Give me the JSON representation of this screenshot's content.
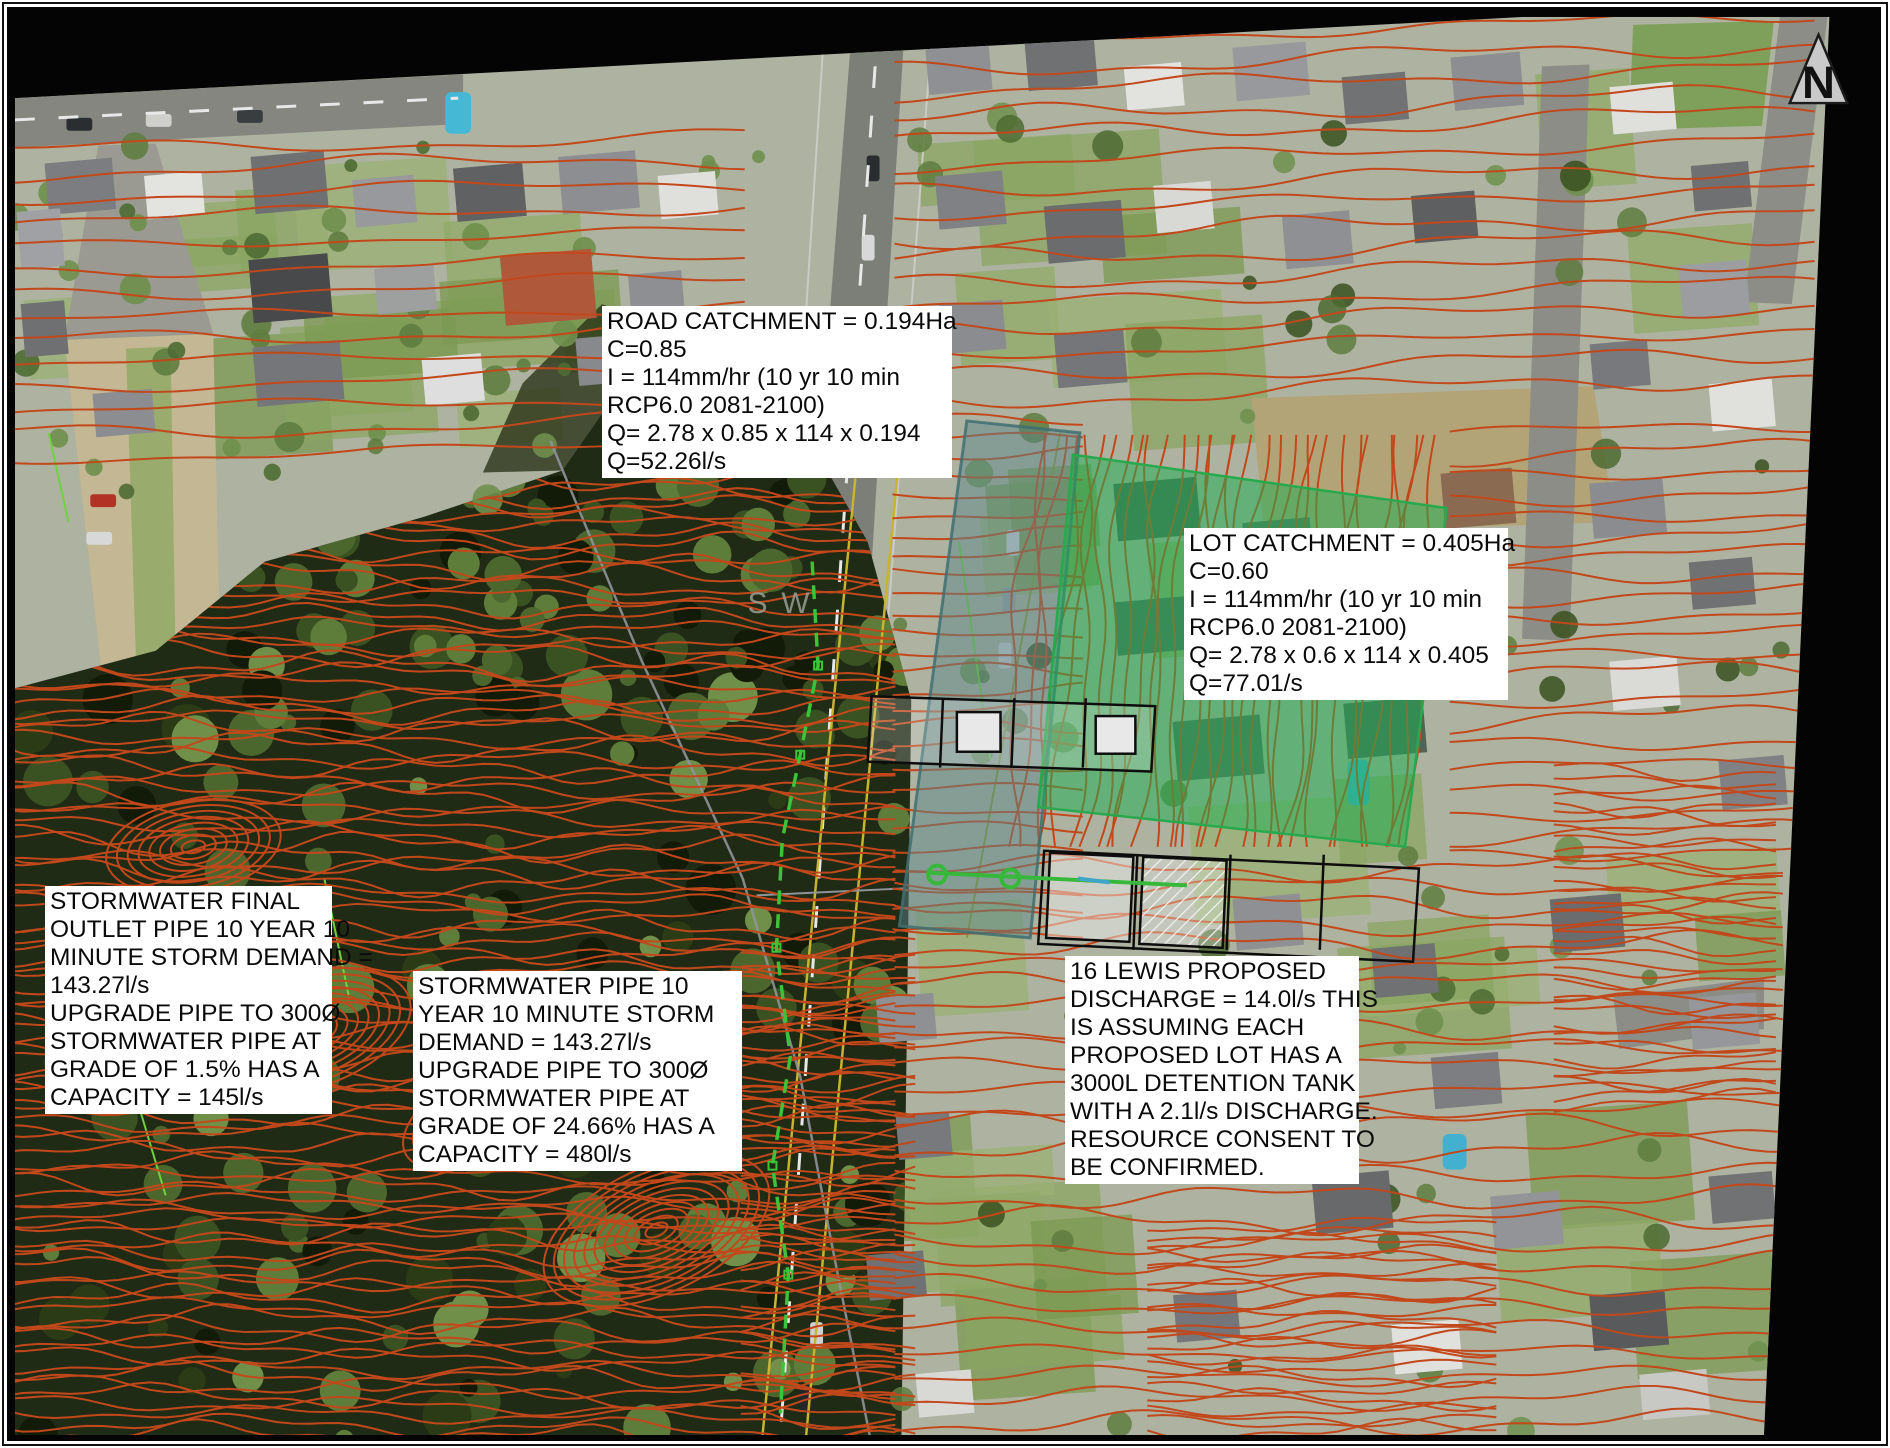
{
  "annotations": {
    "road_catchment": {
      "lines": [
        "ROAD CATCHMENT = 0.194Ha",
        "C=0.85",
        "I = 114mm/hr (10 yr 10 min",
        "RCP6.0 2081-2100)",
        "Q= 2.78 x 0.85 x 114 x 0.194",
        "Q=52.26l/s"
      ]
    },
    "lot_catchment": {
      "lines": [
        "LOT CATCHMENT = 0.405Ha",
        "C=0.60",
        "I = 114mm/hr (10 yr 10 min",
        "RCP6.0 2081-2100)",
        "Q= 2.78 x 0.6 x 114 x 0.405",
        "Q=77.01/s"
      ]
    },
    "stormwater_outlet": {
      "lines": [
        "STORMWATER FINAL",
        "OUTLET PIPE 10 YEAR 10",
        "MINUTE STORM DEMAND =",
        "143.27l/s",
        "UPGRADE PIPE TO 300Ø",
        "STORMWATER PIPE AT",
        "GRADE OF 1.5% HAS A",
        "CAPACITY = 145l/s"
      ]
    },
    "stormwater_pipe": {
      "lines": [
        "STORMWATER PIPE 10",
        "YEAR 10 MINUTE STORM",
        "DEMAND = 143.27l/s",
        "UPGRADE PIPE TO 300Ø",
        "STORMWATER PIPE AT",
        "GRADE OF 24.66% HAS A",
        "CAPACITY = 480l/s"
      ]
    },
    "lewis_discharge": {
      "lines": [
        "16 LEWIS PROPOSED",
        "DISCHARGE = 14.0l/s THIS",
        "IS ASSUMING EACH",
        "PROPOSED LOT HAS A",
        "3000L DETENTION TANK",
        "WITH A 2.1l/s DISCHARGE.",
        "RESOURCE CONSENT TO",
        "BE CONFIRMED."
      ]
    }
  },
  "compass": {
    "label": "N"
  },
  "map_labels": {
    "sw": "SW"
  },
  "colors": {
    "contour": "#c2481b",
    "lot_overlay_fill": "#1fae52",
    "lot_overlay_stroke": "#28a94e",
    "road_overlay_fill": "#59868a",
    "road_overlay_stroke": "#3f6e72",
    "pipe_green": "#3bc438",
    "pipe_gray": "#8f949a",
    "road_yellow": "#c9b42f",
    "lot_plan_black": "#0d0d0d"
  }
}
